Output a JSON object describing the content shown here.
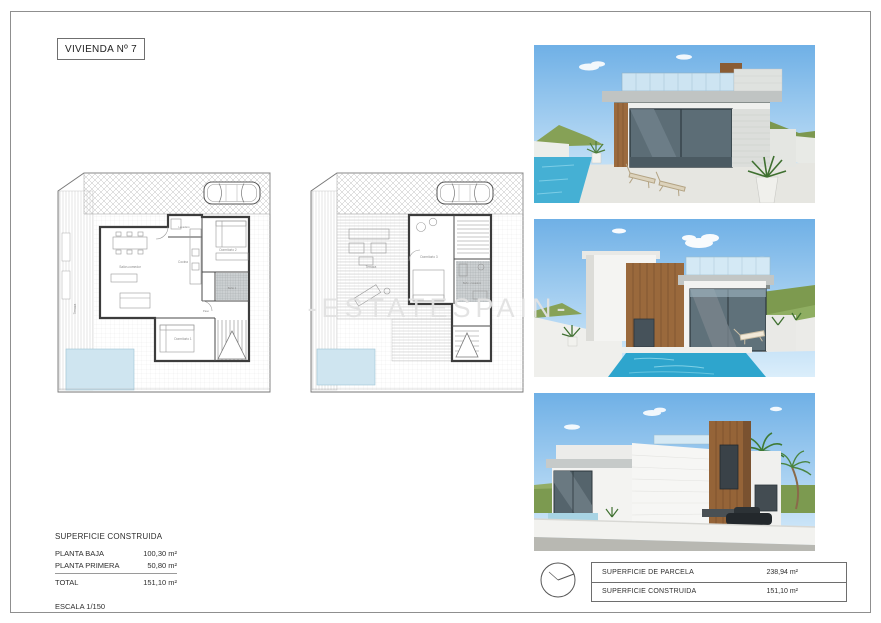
{
  "page": {
    "title": "VIVIENDA Nº 7",
    "watermark": "-ESTATESPAIN-"
  },
  "plans": {
    "ground": {
      "labels": {
        "salon": "Salón-comedor",
        "cocina": "Cocina",
        "lavadero": "Lavadero",
        "dorm2": "Dormitorio 2",
        "bano1": "Baño 1",
        "paso": "Paso",
        "dorm1": "Dormitorio 1",
        "terraza": "Terraza"
      }
    },
    "first": {
      "labels": {
        "terraza": "Terraza",
        "dorm3": "Dormitorio 3",
        "bano2": "Baño + lavadero"
      }
    }
  },
  "summary": {
    "title": "SUPERFICIE CONSTRUIDA",
    "rows": [
      {
        "label": "PLANTA BAJA",
        "value": "100,30 m²"
      },
      {
        "label": "PLANTA PRIMERA",
        "value": "50,80 m²"
      }
    ],
    "total": {
      "label": "TOTAL",
      "value": "151,10 m²"
    },
    "scale": "ESCALA 1/150"
  },
  "parcel_table": {
    "rows": [
      {
        "label": "SUPERFICIE DE PARCELA",
        "value": "238,94 m²"
      },
      {
        "label": "SUPERFICIE CONSTRUIDA",
        "value": "151,10 m²"
      }
    ]
  },
  "colors": {
    "pool_plan": "#cfe5f0",
    "pool_render": "#35a9cf",
    "wood": "#99663c",
    "sky": "#74b2e4"
  }
}
